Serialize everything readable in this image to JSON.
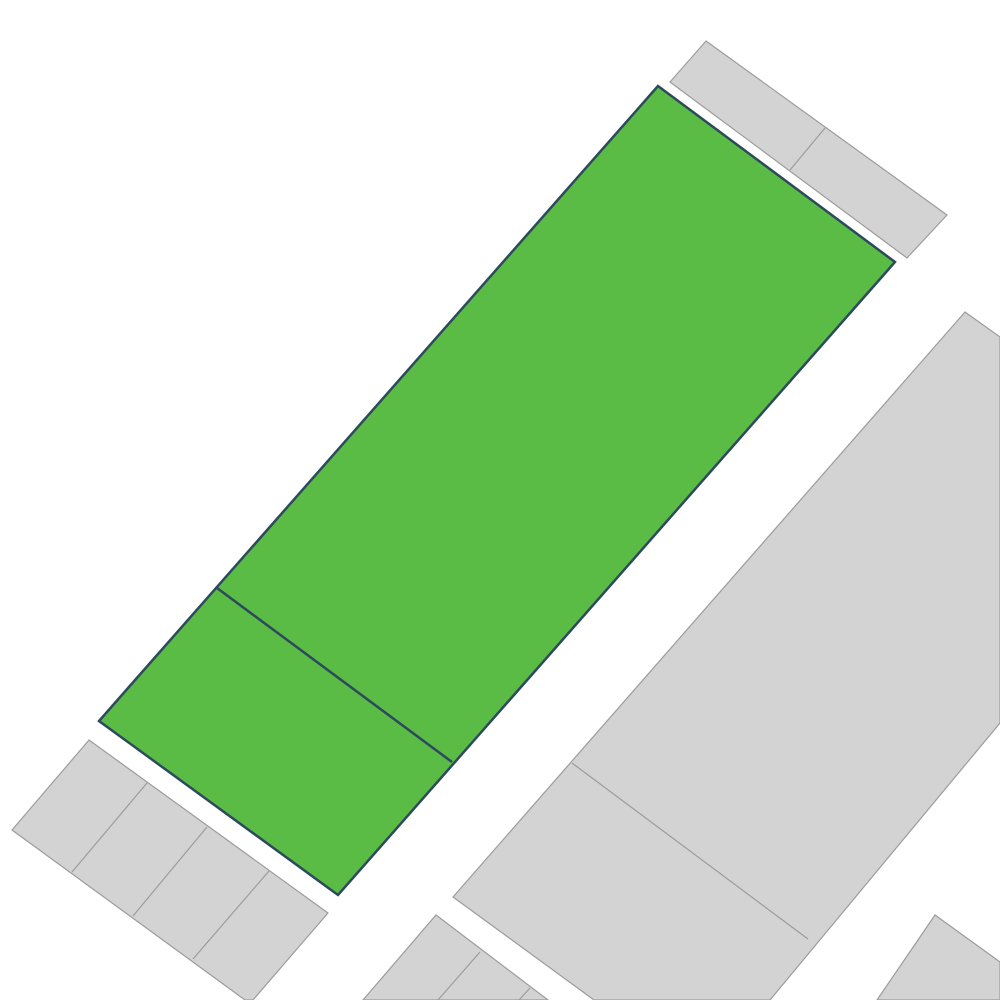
{
  "map": {
    "background": "#ffffff",
    "default_style": {
      "fill": "#d3d3d3",
      "stroke": "#9c9c9c",
      "stroke_width": 1.2
    },
    "selected_style": {
      "fill": "#5abb45",
      "stroke": "#2d4a5c",
      "stroke_width": 2.5
    },
    "parcels": [
      {
        "name": "top-right-strip",
        "selected": false,
        "outline": [
          [
            706,
            41
          ],
          [
            947,
            215
          ],
          [
            907,
            258
          ],
          [
            670,
            82
          ]
        ],
        "divisions": [
          [
            [
              825,
              128
            ],
            [
              790,
              170
            ]
          ]
        ]
      },
      {
        "name": "large-right-parcel",
        "selected": false,
        "outline": [
          [
            965,
            312
          ],
          [
            1000,
            337
          ],
          [
            1000,
            723
          ],
          [
            770,
            1000
          ],
          [
            594,
            1000
          ],
          [
            453,
            897
          ]
        ],
        "divisions": [
          [
            [
              572,
              763
            ],
            [
              808,
              939
            ]
          ]
        ]
      },
      {
        "name": "bottom-left-strip",
        "selected": false,
        "outline": [
          [
            89,
            740
          ],
          [
            328,
            913
          ],
          [
            253,
            1000
          ],
          [
            245,
            1000
          ],
          [
            12,
            830
          ]
        ],
        "divisions": [
          [
            [
              147,
              783
            ],
            [
              72,
              872
            ]
          ],
          [
            [
              207,
              827
            ],
            [
              133,
              916
            ]
          ],
          [
            [
              269,
              871
            ],
            [
              193,
              959
            ]
          ]
        ]
      },
      {
        "name": "bottom-center-strip",
        "selected": false,
        "outline": [
          [
            436,
            915
          ],
          [
            548,
            1000
          ],
          [
            363,
            1000
          ]
        ],
        "divisions": [
          [
            [
              480,
              952
            ],
            [
              438,
              1000
            ]
          ],
          [
            [
              530,
              988
            ],
            [
              519,
              1000
            ]
          ]
        ]
      },
      {
        "name": "bottom-right-corner-parcel",
        "selected": false,
        "outline": [
          [
            935,
            915
          ],
          [
            1000,
            962
          ],
          [
            1000,
            1000
          ],
          [
            877,
            1000
          ]
        ],
        "divisions": []
      },
      {
        "name": "selected-parcel",
        "selected": true,
        "outline": [
          [
            658,
            86
          ],
          [
            895,
            262
          ],
          [
            338,
            895
          ],
          [
            99,
            721
          ]
        ],
        "divisions": [
          [
            [
              217,
              588
            ],
            [
              452,
              762
            ]
          ]
        ]
      }
    ]
  }
}
